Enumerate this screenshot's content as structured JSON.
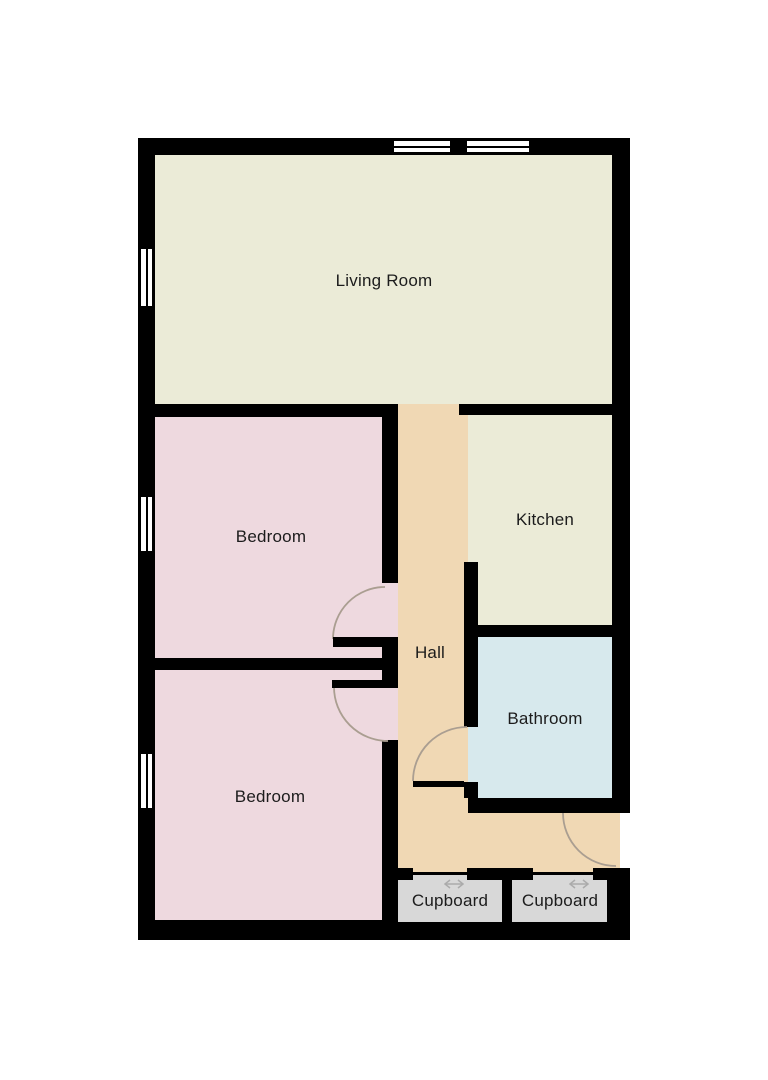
{
  "plan": {
    "rooms": {
      "living_room": {
        "label": "Living Room"
      },
      "bedroom_1": {
        "label": "Bedroom"
      },
      "bedroom_2": {
        "label": "Bedroom"
      },
      "kitchen": {
        "label": "Kitchen"
      },
      "hall": {
        "label": "Hall"
      },
      "bathroom": {
        "label": "Bathroom"
      },
      "cupboard_1": {
        "label": "Cupboard"
      },
      "cupboard_2": {
        "label": "Cupboard"
      }
    },
    "features": {
      "windows": [
        "top-wall-window-1",
        "top-wall-window-2",
        "left-wall-window-living-room",
        "left-wall-window-bedroom-1",
        "left-wall-window-bedroom-2"
      ],
      "hinged_doors": [
        "bedroom-1-door",
        "bedroom-2-door",
        "bathroom-door",
        "entrance-door"
      ],
      "sliding_doors": [
        "cupboard-1-sliding-door",
        "cupboard-2-sliding-door"
      ]
    },
    "colors": {
      "wall": "#000000",
      "living_room": "#ebebd7",
      "kitchen": "#ebebd7",
      "bedroom": "#eed9df",
      "hall": "#f0d8b4",
      "bathroom": "#d7e9ed",
      "cupboard": "#d8d8d8",
      "window": "#ffffff",
      "door_arc": "#aa9e91",
      "slide_arrow": "#ababab",
      "label_text": "#1c1c1c",
      "background": "#ffffff"
    }
  }
}
